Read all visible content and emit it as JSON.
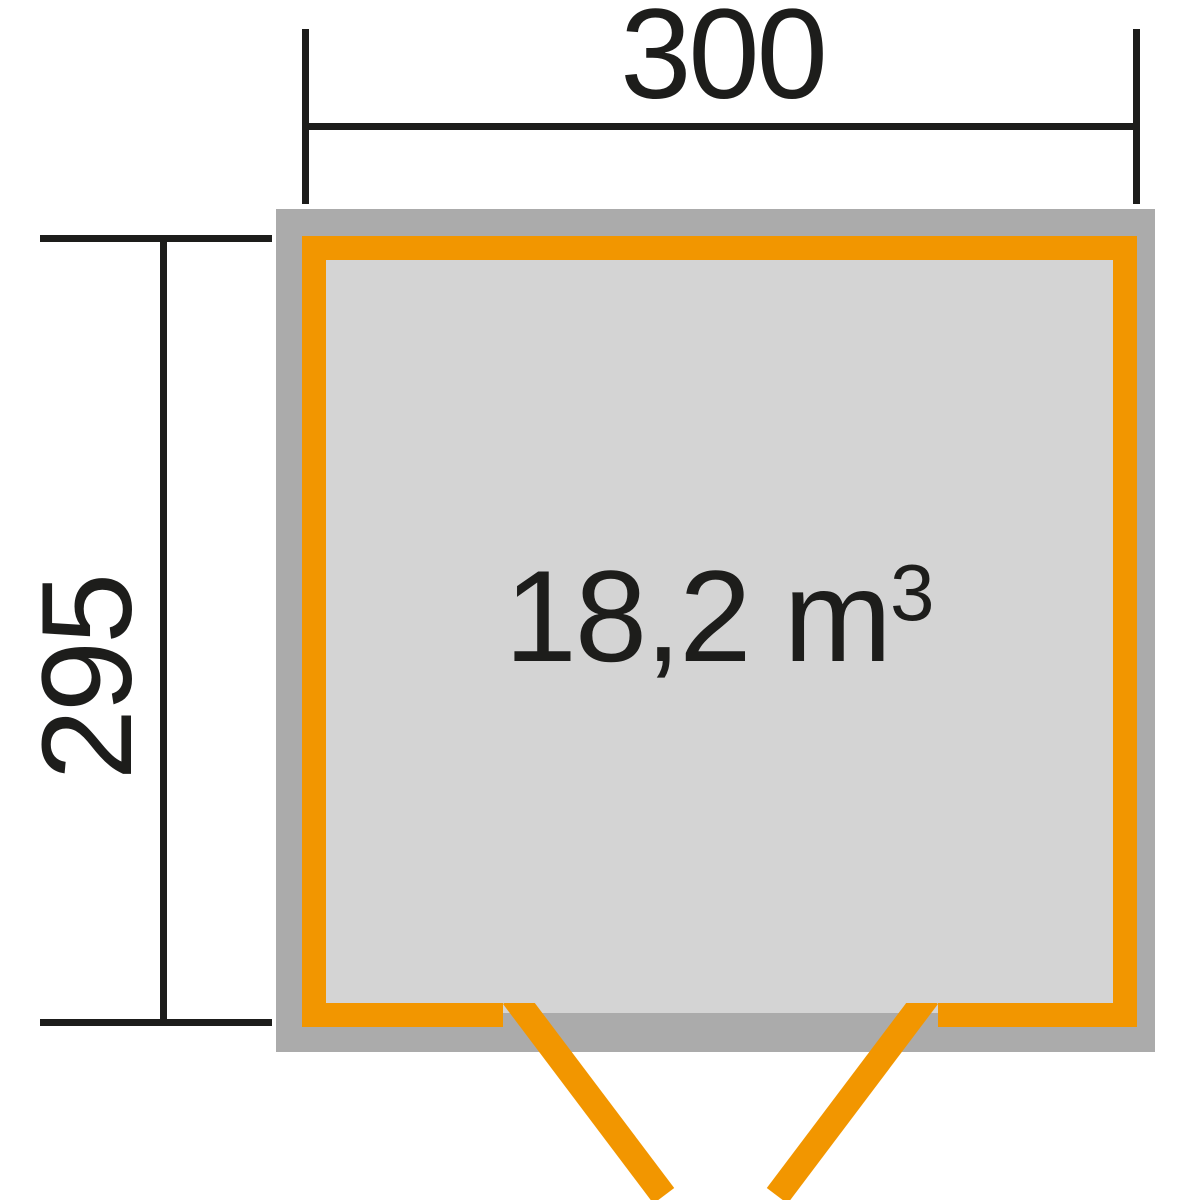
{
  "diagram": {
    "type": "shed-floor-plan",
    "dimensions": {
      "width": "300",
      "depth": "295"
    },
    "volume": {
      "text": "18,2 m",
      "superscript": "3"
    },
    "colors": {
      "orange": "#F29600",
      "roof-gray": "#ABABAB",
      "floor-gray": "#D4D4D4",
      "line": "#1D1D1B",
      "background": "#FFFFFF"
    }
  }
}
